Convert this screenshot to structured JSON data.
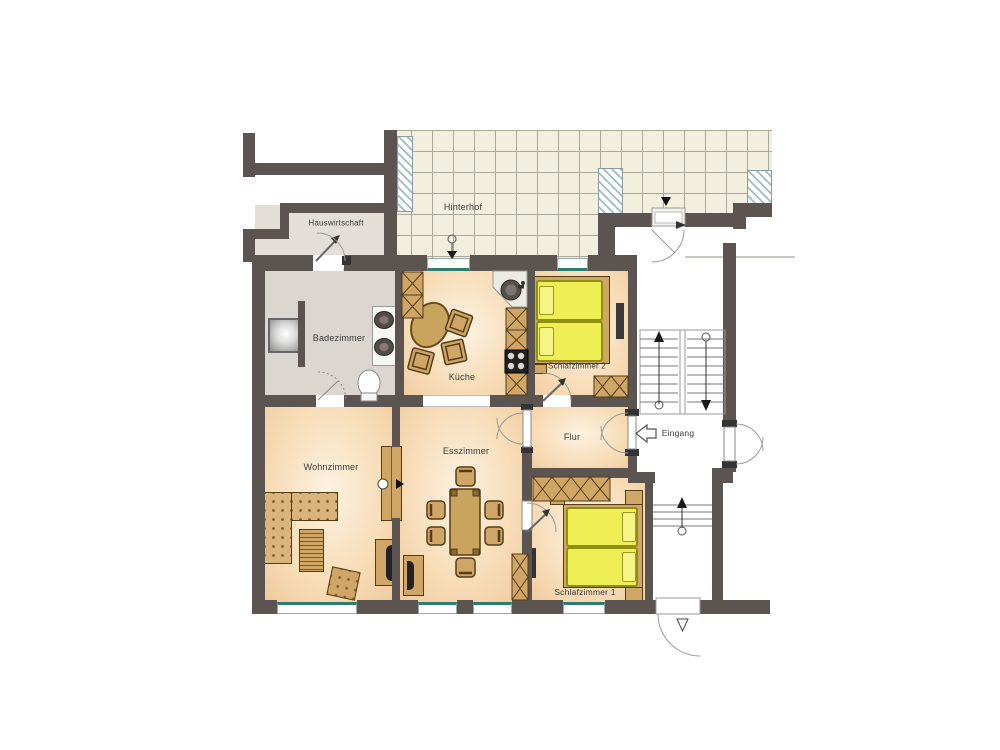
{
  "floorplan": {
    "type": "apartment-floor-plan",
    "language": "de",
    "rooms": [
      {
        "id": "hauswirtschaft",
        "label": "Hauswirtschaft"
      },
      {
        "id": "hinterhof",
        "label": "Hinterhof"
      },
      {
        "id": "badezimmer",
        "label": "Badezimmer"
      },
      {
        "id": "kueche",
        "label": "Küche"
      },
      {
        "id": "schlafzimmer-2",
        "label": "Schlafzimmer 2"
      },
      {
        "id": "wohnzimmer",
        "label": "Wohnzimmer"
      },
      {
        "id": "esszimmer",
        "label": "Esszimmer"
      },
      {
        "id": "flur",
        "label": "Flur"
      },
      {
        "id": "eingang",
        "label": "Eingang"
      },
      {
        "id": "schlafzimmer-1",
        "label": "Schlafzimmer 1"
      }
    ],
    "colors": {
      "wall": "#5b5450",
      "tile": "#f3efdf",
      "tile-line": "#a9a99b",
      "hatch-line": "#9dbcc8",
      "bed-yellow": "#f0ee55",
      "bed-yellow-dark": "#8f8f12",
      "furniture-tan": "#cfa666",
      "furniture-dark": "#543d16",
      "window-teal": "#2e7d6e",
      "label-text": "#3a3a3a"
    }
  }
}
